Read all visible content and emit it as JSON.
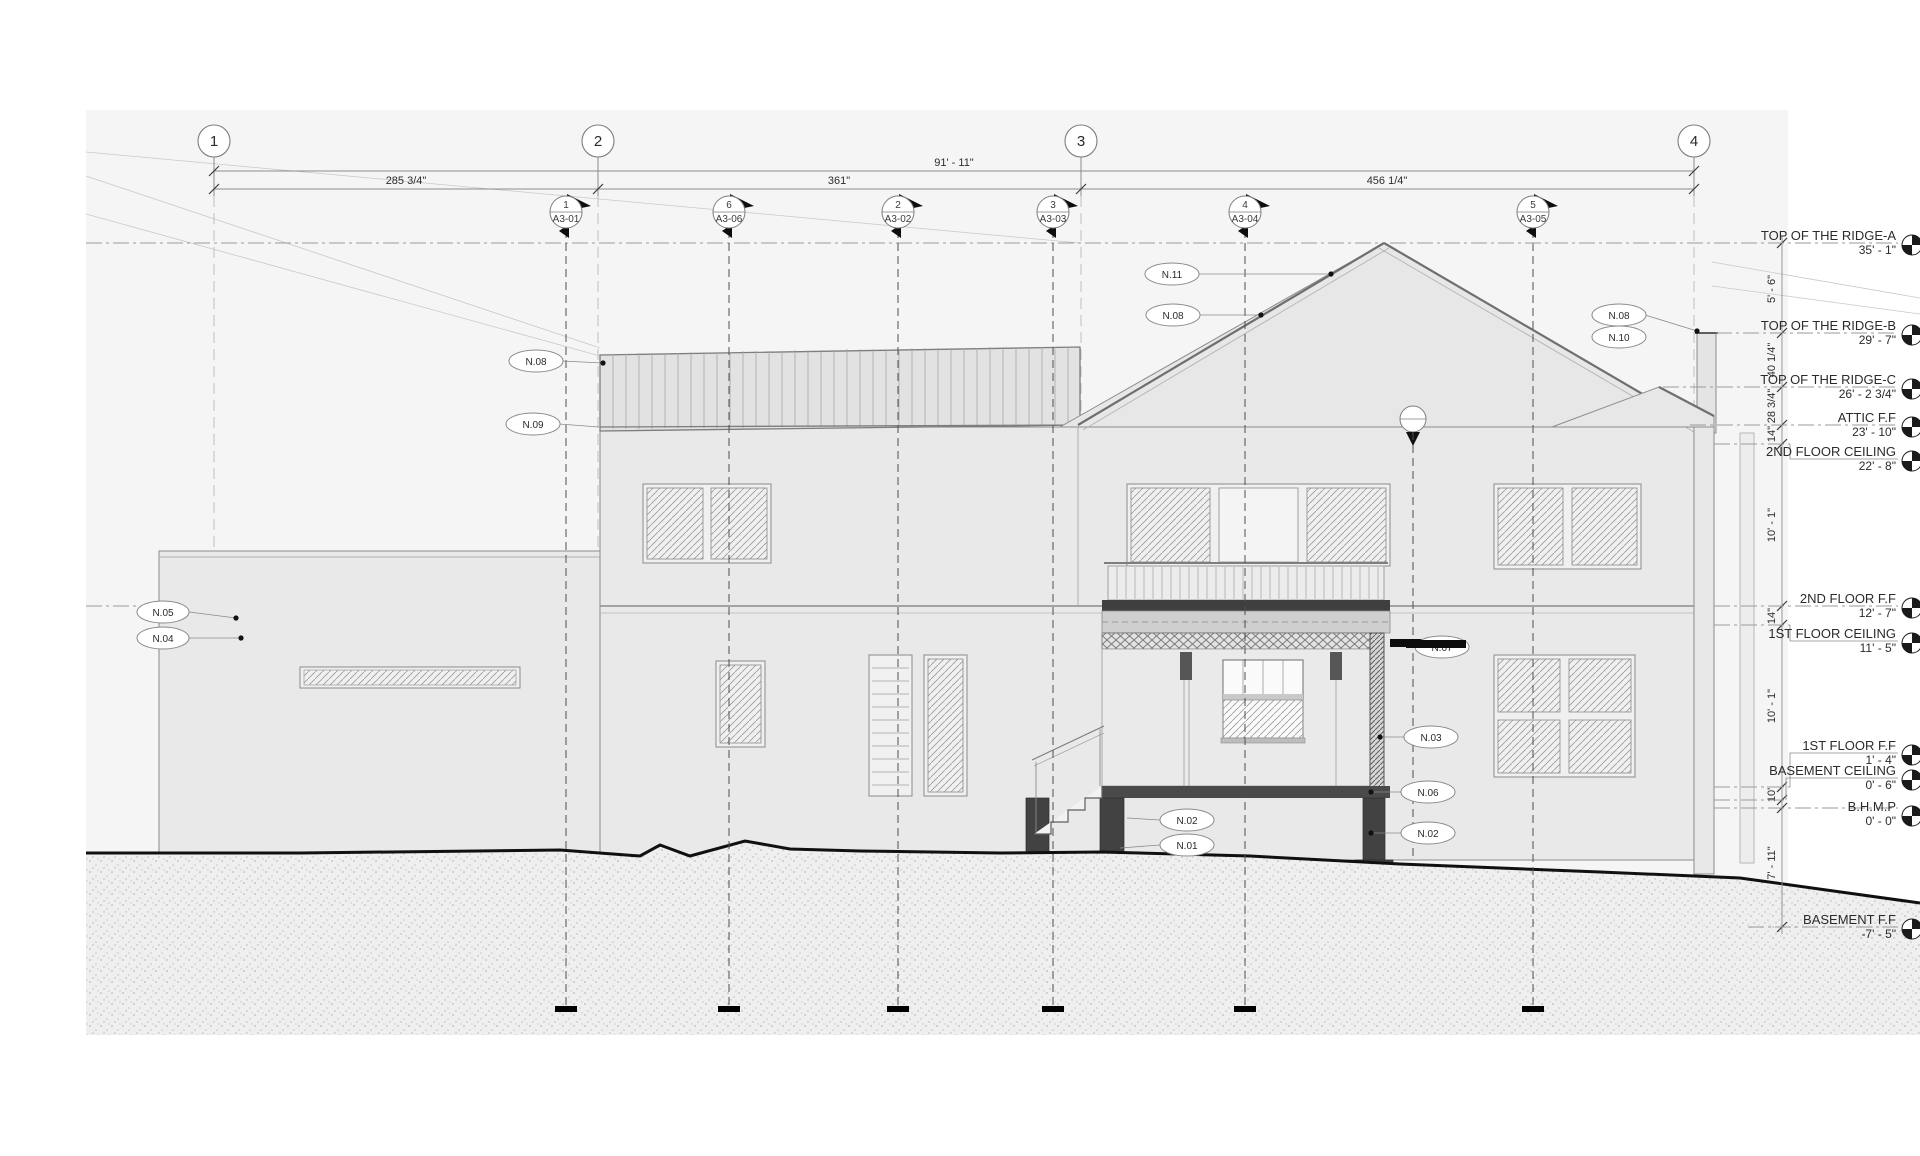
{
  "drawing": {
    "grids": [
      {
        "label": "1"
      },
      {
        "label": "2"
      },
      {
        "label": "3"
      },
      {
        "label": "4"
      }
    ],
    "dims": {
      "overall": "91' - 11\"",
      "seg1": "285 3/4\"",
      "seg2": "361\"",
      "seg3": "456 1/4\""
    },
    "markers": [
      {
        "num": "1",
        "sheet": "A3-01"
      },
      {
        "num": "6",
        "sheet": "A3-06"
      },
      {
        "num": "2",
        "sheet": "A3-02"
      },
      {
        "num": "3",
        "sheet": "A3-03"
      },
      {
        "num": "4",
        "sheet": "A3-04"
      },
      {
        "num": "5",
        "sheet": "A3-05"
      }
    ],
    "levels": [
      {
        "name": "TOP OF THE RIDGE-A",
        "elev": "35' - 1\""
      },
      {
        "name": "TOP OF THE RIDGE-B",
        "elev": "29' - 7\""
      },
      {
        "name": "TOP OF THE RIDGE-C",
        "elev": "26' - 2 3/4\""
      },
      {
        "name": "ATTIC F.F",
        "elev": "23' - 10\""
      },
      {
        "name": "2ND FLOOR CEILING",
        "elev": "22' - 8\""
      },
      {
        "name": "2ND FLOOR F.F",
        "elev": "12' - 7\""
      },
      {
        "name": "1ST FLOOR CEILING",
        "elev": "11' - 5\""
      },
      {
        "name": "1ST FLOOR F.F",
        "elev": "1' - 4\""
      },
      {
        "name": "BASEMENT CEILING",
        "elev": "0' - 6\""
      },
      {
        "name": "B.H.M.P",
        "elev": "0' - 0\""
      },
      {
        "name": "BASEMENT F.F",
        "elev": "-7' - 5\""
      }
    ],
    "vdims": [
      "5' - 6\"",
      "40 1/4\"",
      "28 3/4\"",
      "14\"",
      "10' - 1\"",
      "14\"",
      "10' - 1\"",
      "10\"",
      "7' - 11\""
    ],
    "tags": {
      "roof": "N.08",
      "eave": "N.09",
      "ridge_left": "N.11",
      "gable": "N.08",
      "chimney_a": "N.08",
      "chimney_b": "N.10",
      "balcony": "N.07",
      "wall": "N.03",
      "beam": "N.06",
      "pier": "N.02",
      "stair_a": "N.02",
      "stair_b": "N.01",
      "garage_a": "N.05",
      "garage_b": "N.04"
    }
  }
}
